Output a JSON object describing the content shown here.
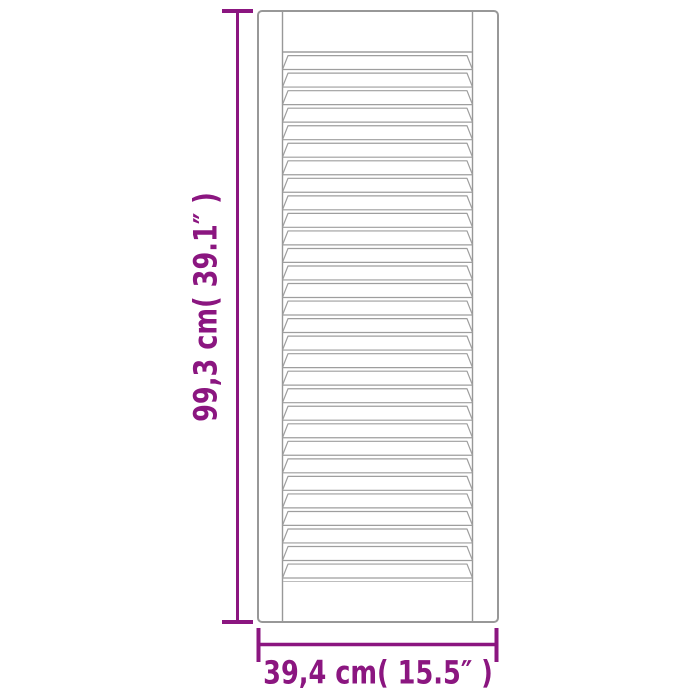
{
  "meta": {
    "description": "Product dimension diagram of a white louvred (slatted) door panel",
    "background": "#ffffff"
  },
  "labels": {
    "height": "99,3 cm( 39.1″ )",
    "width": "39,4 cm( 15.5″ )"
  },
  "colors": {
    "dimension_accent": "#8B1680",
    "door_outline": "#989898",
    "slat_line": "#9E9E9E",
    "door_fill": "#FFFFFF"
  },
  "door": {
    "louver_count": 30
  }
}
